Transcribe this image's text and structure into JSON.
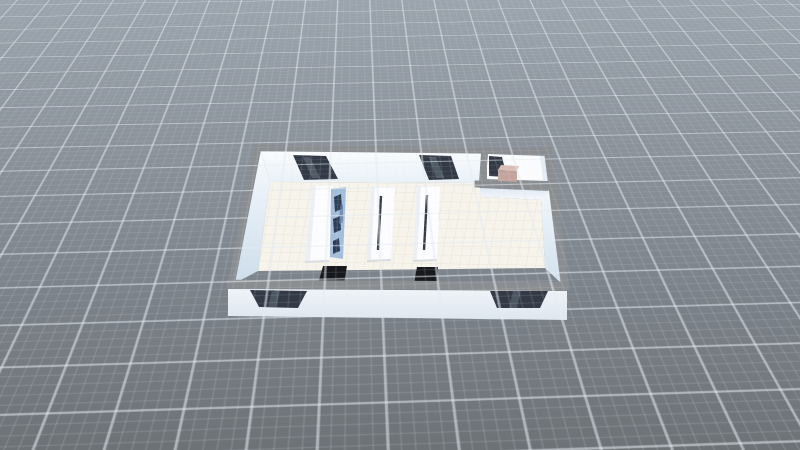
{
  "viewport": {
    "app_context": "3d-floorplan-view",
    "visible_text": [],
    "ground": {
      "grid_visible": true,
      "bg_top": "#9ba3ac",
      "bg_mid": "#858c94",
      "bg_bottom": "#6d7277",
      "grid_line": "#e4ebf1"
    },
    "colors": {
      "wall_cap": "#8b8e91",
      "left_wall_top": "#f8fbfe",
      "left_wall_bottom": "#cdddeb",
      "back_wall_top": "#fbfdfe",
      "back_wall_bottom": "#e9f1f8",
      "right_wall_top": "#f3f8fc",
      "right_wall_bottom": "#d3e1ed",
      "closet_face_top": "#dfe9f2",
      "closet_face_bottom": "#f5f9fc",
      "front_ext_top": "#f0f4f9",
      "front_ext_bottom": "#dee6ef",
      "floor": "#f7f4ec",
      "tile_line": "#e8e1d3",
      "door_dark": "#333a46",
      "door_streak": "#59636f",
      "closet_floor": "#fbfcfd",
      "closet_wall_shade": "#e4edf4",
      "cabinet_top": "#dabdb5",
      "cabinet_front": "#c3a49d",
      "table_white": "#fdfdff",
      "table_shade": "#e7ebf0",
      "table_edge": "#d8dce1",
      "table_seam": "#353c46",
      "screen_blue": "#a3bedb",
      "screen_dark": "#2b3d55",
      "screen_mid": "#5f7ba0",
      "stool_black": "#17191d"
    },
    "objects": {
      "room": "rectangular room, bird's-eye 3D view",
      "closet": "small closet room at top-right corner",
      "back_doors": 2,
      "front_doors": 2,
      "closet_doors": 1,
      "tables": 3,
      "screen_panels": 1,
      "stools": 2,
      "cabinets": 1
    }
  }
}
